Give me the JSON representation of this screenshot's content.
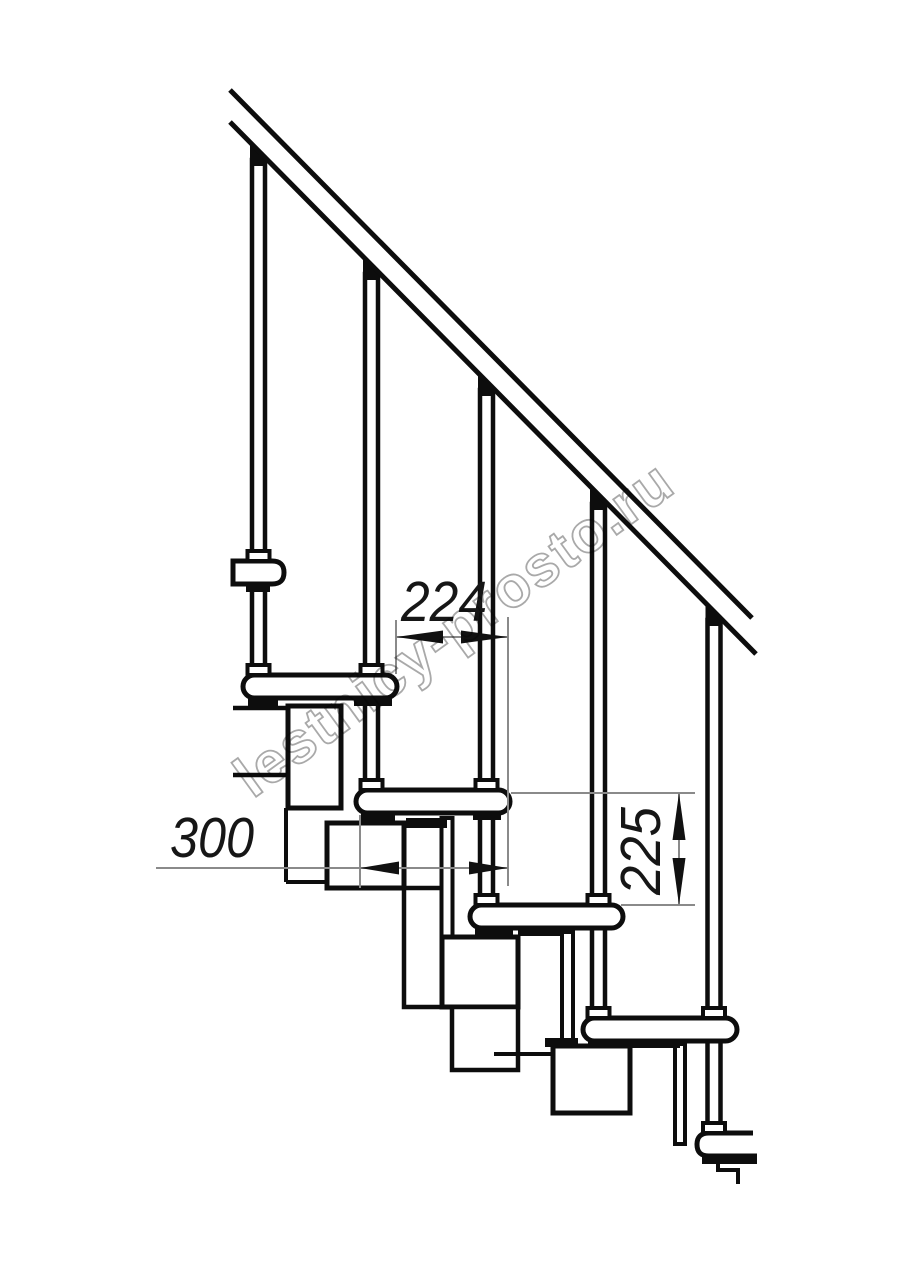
{
  "page": {
    "background": "#ffffff",
    "description": "Technical side-elevation drawing of a modular staircase"
  },
  "watermark": {
    "text": "lestnicy-prosto.ru",
    "color": "#a9a9a9"
  },
  "drawing": {
    "type": "staircase-side-elevation",
    "line_color": "#0d0d0d",
    "thin_line_color": "#8a8a8a",
    "fill_color": "#ffffff",
    "balusters_count": 5,
    "treads_count": 5,
    "handrail": "diagonal double line, upper left to lower right",
    "dimensions": [
      {
        "id": "step-run",
        "value": "224",
        "orientation": "horizontal"
      },
      {
        "id": "tread-depth",
        "value": "300",
        "orientation": "horizontal"
      },
      {
        "id": "riser-height",
        "value": "225",
        "orientation": "vertical"
      }
    ]
  }
}
